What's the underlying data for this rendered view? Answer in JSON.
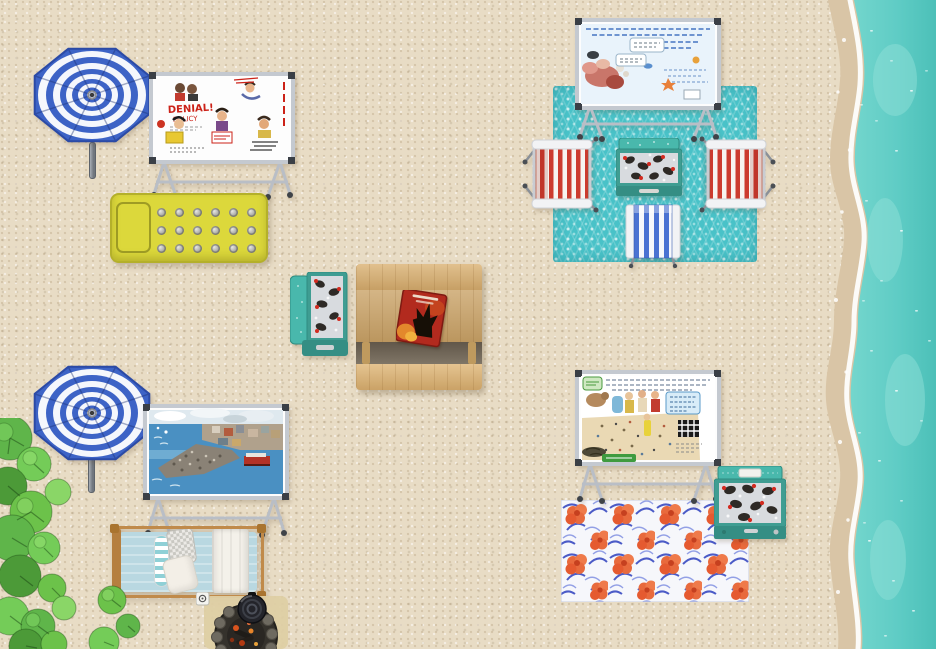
{
  "scene": {
    "type": "top-down-virtual-beach-map",
    "shoreline_side": "right",
    "inventory": [
      "striped beach umbrella x2",
      "whiteboard easel with poster x4",
      "yellow slatted sun lounger",
      "teal picnic blanket",
      "floral picnic blanket",
      "red striped beach chair x2",
      "blue striped beach chair",
      "open cooler with drinks x3",
      "wooden picnic table",
      "red book",
      "daybed with pillows",
      "stone fire pit with pot",
      "monstera plants",
      "ocean with surf"
    ]
  },
  "poster_labels": {
    "denial_headline": "DENIAL!",
    "denial_subline": "POLICY"
  },
  "palette": {
    "sand": "#e8dcc5",
    "wet_sand": "#d9c5a6",
    "foam": "#ffffff",
    "water": "#5fccc5",
    "water_deep": "#4cc0b8",
    "water_light": "#8fe0d8",
    "umbrella_blue": "#3d63c6",
    "umbrella_white": "#f5f7fc",
    "blanket_teal": "#49c2c8",
    "bench_yellow": "#dcd83b",
    "wood": "#cba56b",
    "cooler_teal": "#49b8ac",
    "cooler_dark": "#3f9d92",
    "chair_red": "#cc3b2e",
    "chair_blue": "#4a72d2",
    "floral_orange": "#e86a3d",
    "floral_blue": "#2d3fbe",
    "plant_green": "#6cc24a",
    "frame_gray": "#b9bec6"
  }
}
